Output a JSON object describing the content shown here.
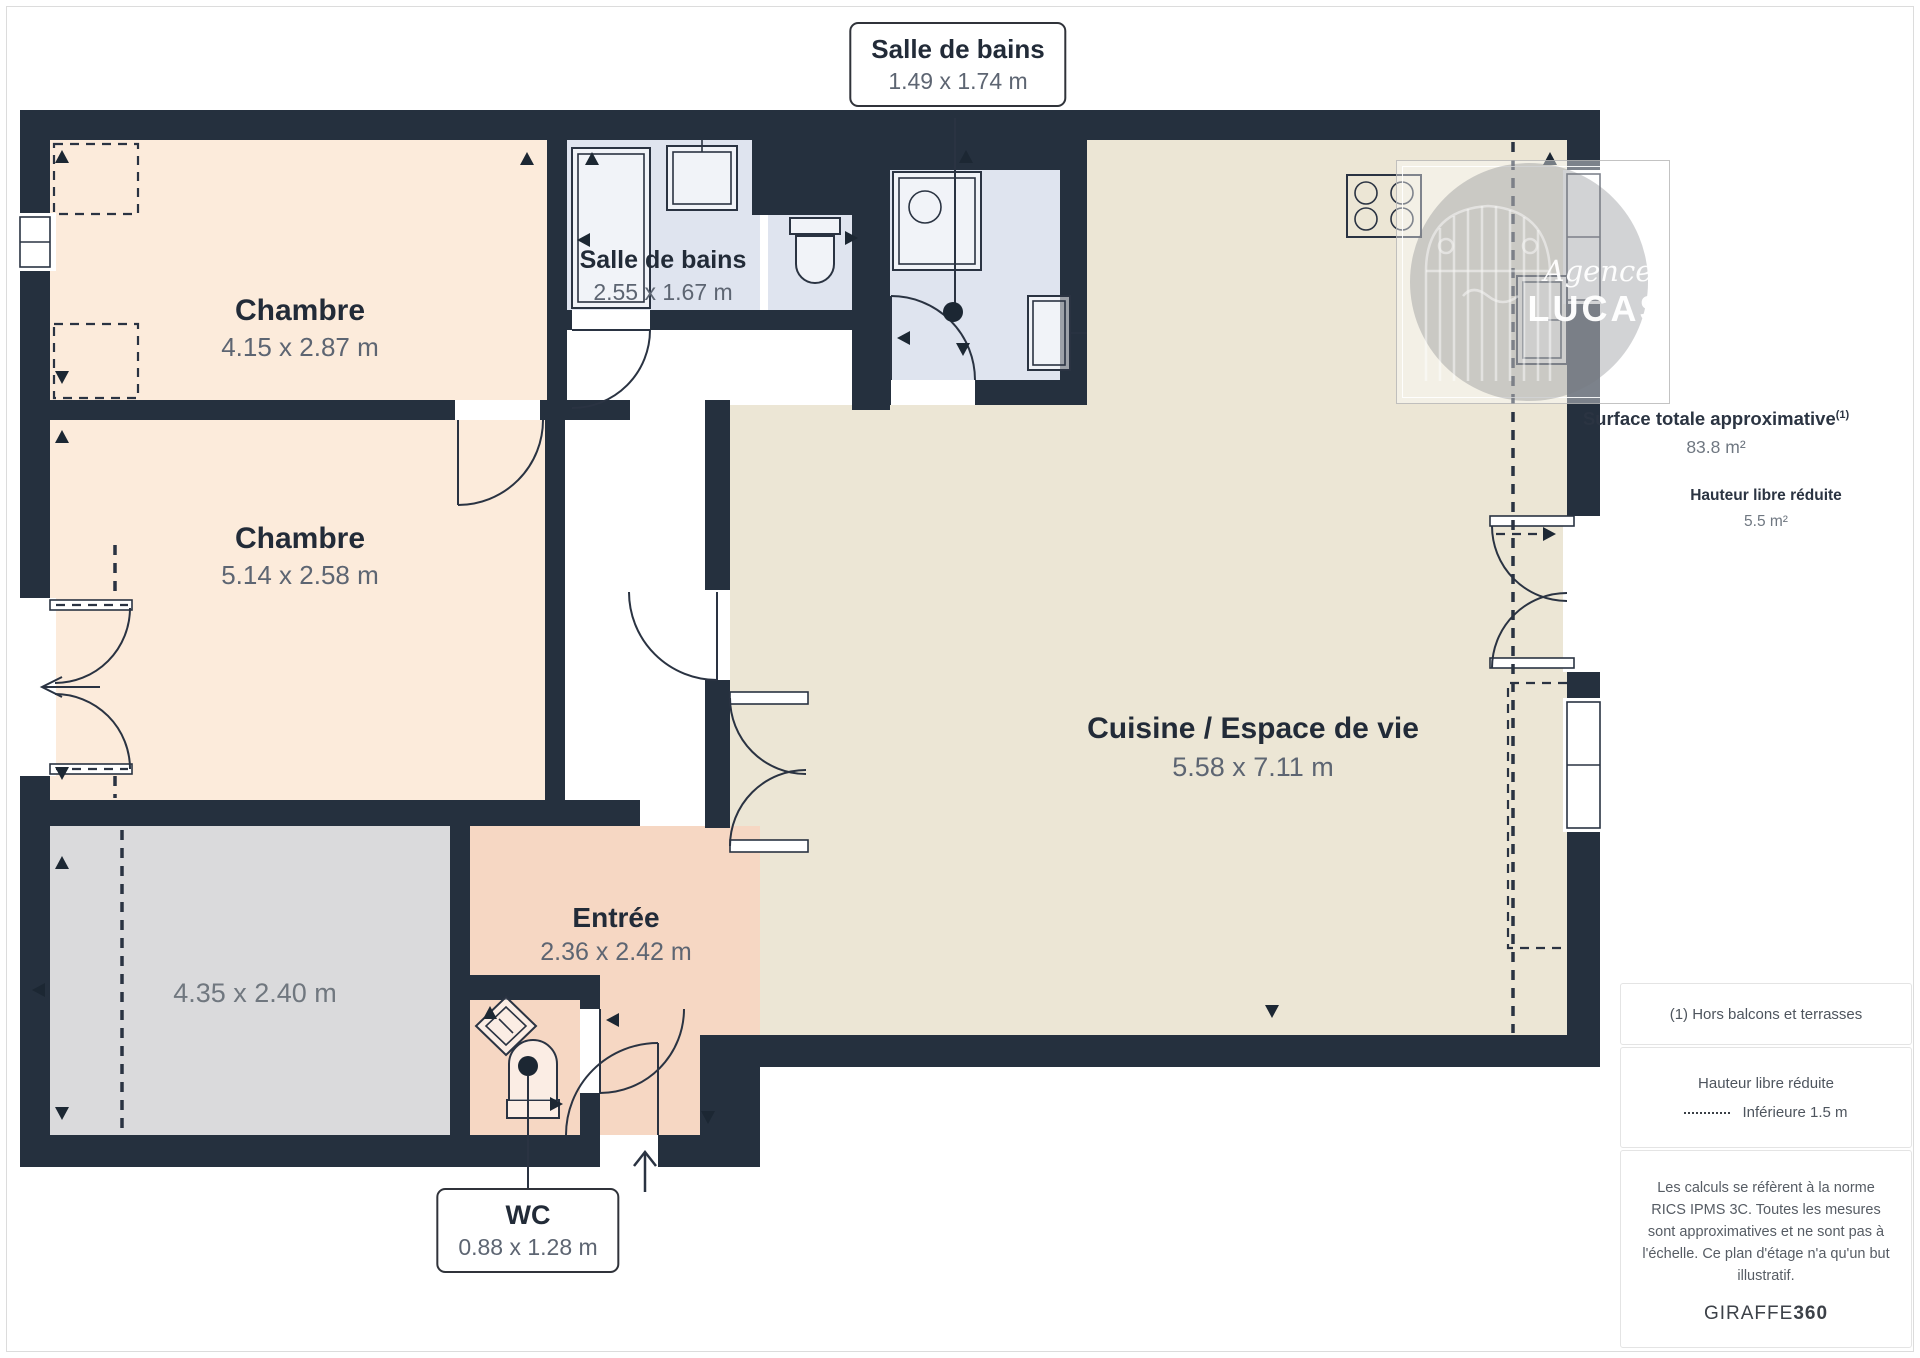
{
  "page": {
    "background": "#ffffff",
    "border": "#dcdcdc"
  },
  "plan": {
    "rooms": [
      {
        "name": "Chambre",
        "dims": "4.15 x 2.87 m"
      },
      {
        "name": "Salle de bains",
        "dims": "2.55 x 1.67 m"
      },
      {
        "name": "Chambre",
        "dims": "5.14 x 2.58 m"
      },
      {
        "name": "",
        "dims": "4.35 x 2.40 m"
      },
      {
        "name": "Entrée",
        "dims": "2.36 x 2.42 m"
      },
      {
        "name": "Cuisine / Espace de vie",
        "dims": "5.58 x 7.11 m"
      }
    ],
    "callouts": {
      "bathroom": {
        "title": "Salle de bains",
        "dims": "1.49 x 1.74 m"
      },
      "wc": {
        "title": "WC",
        "dims": "0.88 x 1.28 m"
      }
    },
    "colors": {
      "wall": "#25303e",
      "bedroom_floor": "#fcebdb",
      "bathroom_floor": "#dfe4ef",
      "kitchen_floor": "#ece6d5",
      "entry_floor": "#f6d7c3",
      "terrace_floor": "#dadadc"
    }
  },
  "watermark": {
    "line1": "Agence",
    "line2": "LUCAS"
  },
  "sidebar": {
    "surface": {
      "label": "Surface totale approximative",
      "sup": "(1)",
      "value": "83.8 m²"
    },
    "height": {
      "label": "Hauteur libre réduite",
      "value": "5.5 m²"
    },
    "note": "(1) Hors balcons et terrasses",
    "legend": {
      "title": "Hauteur libre réduite",
      "value": "Inférieure 1.5 m"
    },
    "legal": "Les calculs se réfèrent à la norme RICS IPMS 3C. Toutes les mesures sont approximatives et ne sont pas à l'échelle. Ce plan d'étage n'a qu'un but illustratif.",
    "brand": {
      "name": "GIRAFFE",
      "bold": "360"
    }
  }
}
